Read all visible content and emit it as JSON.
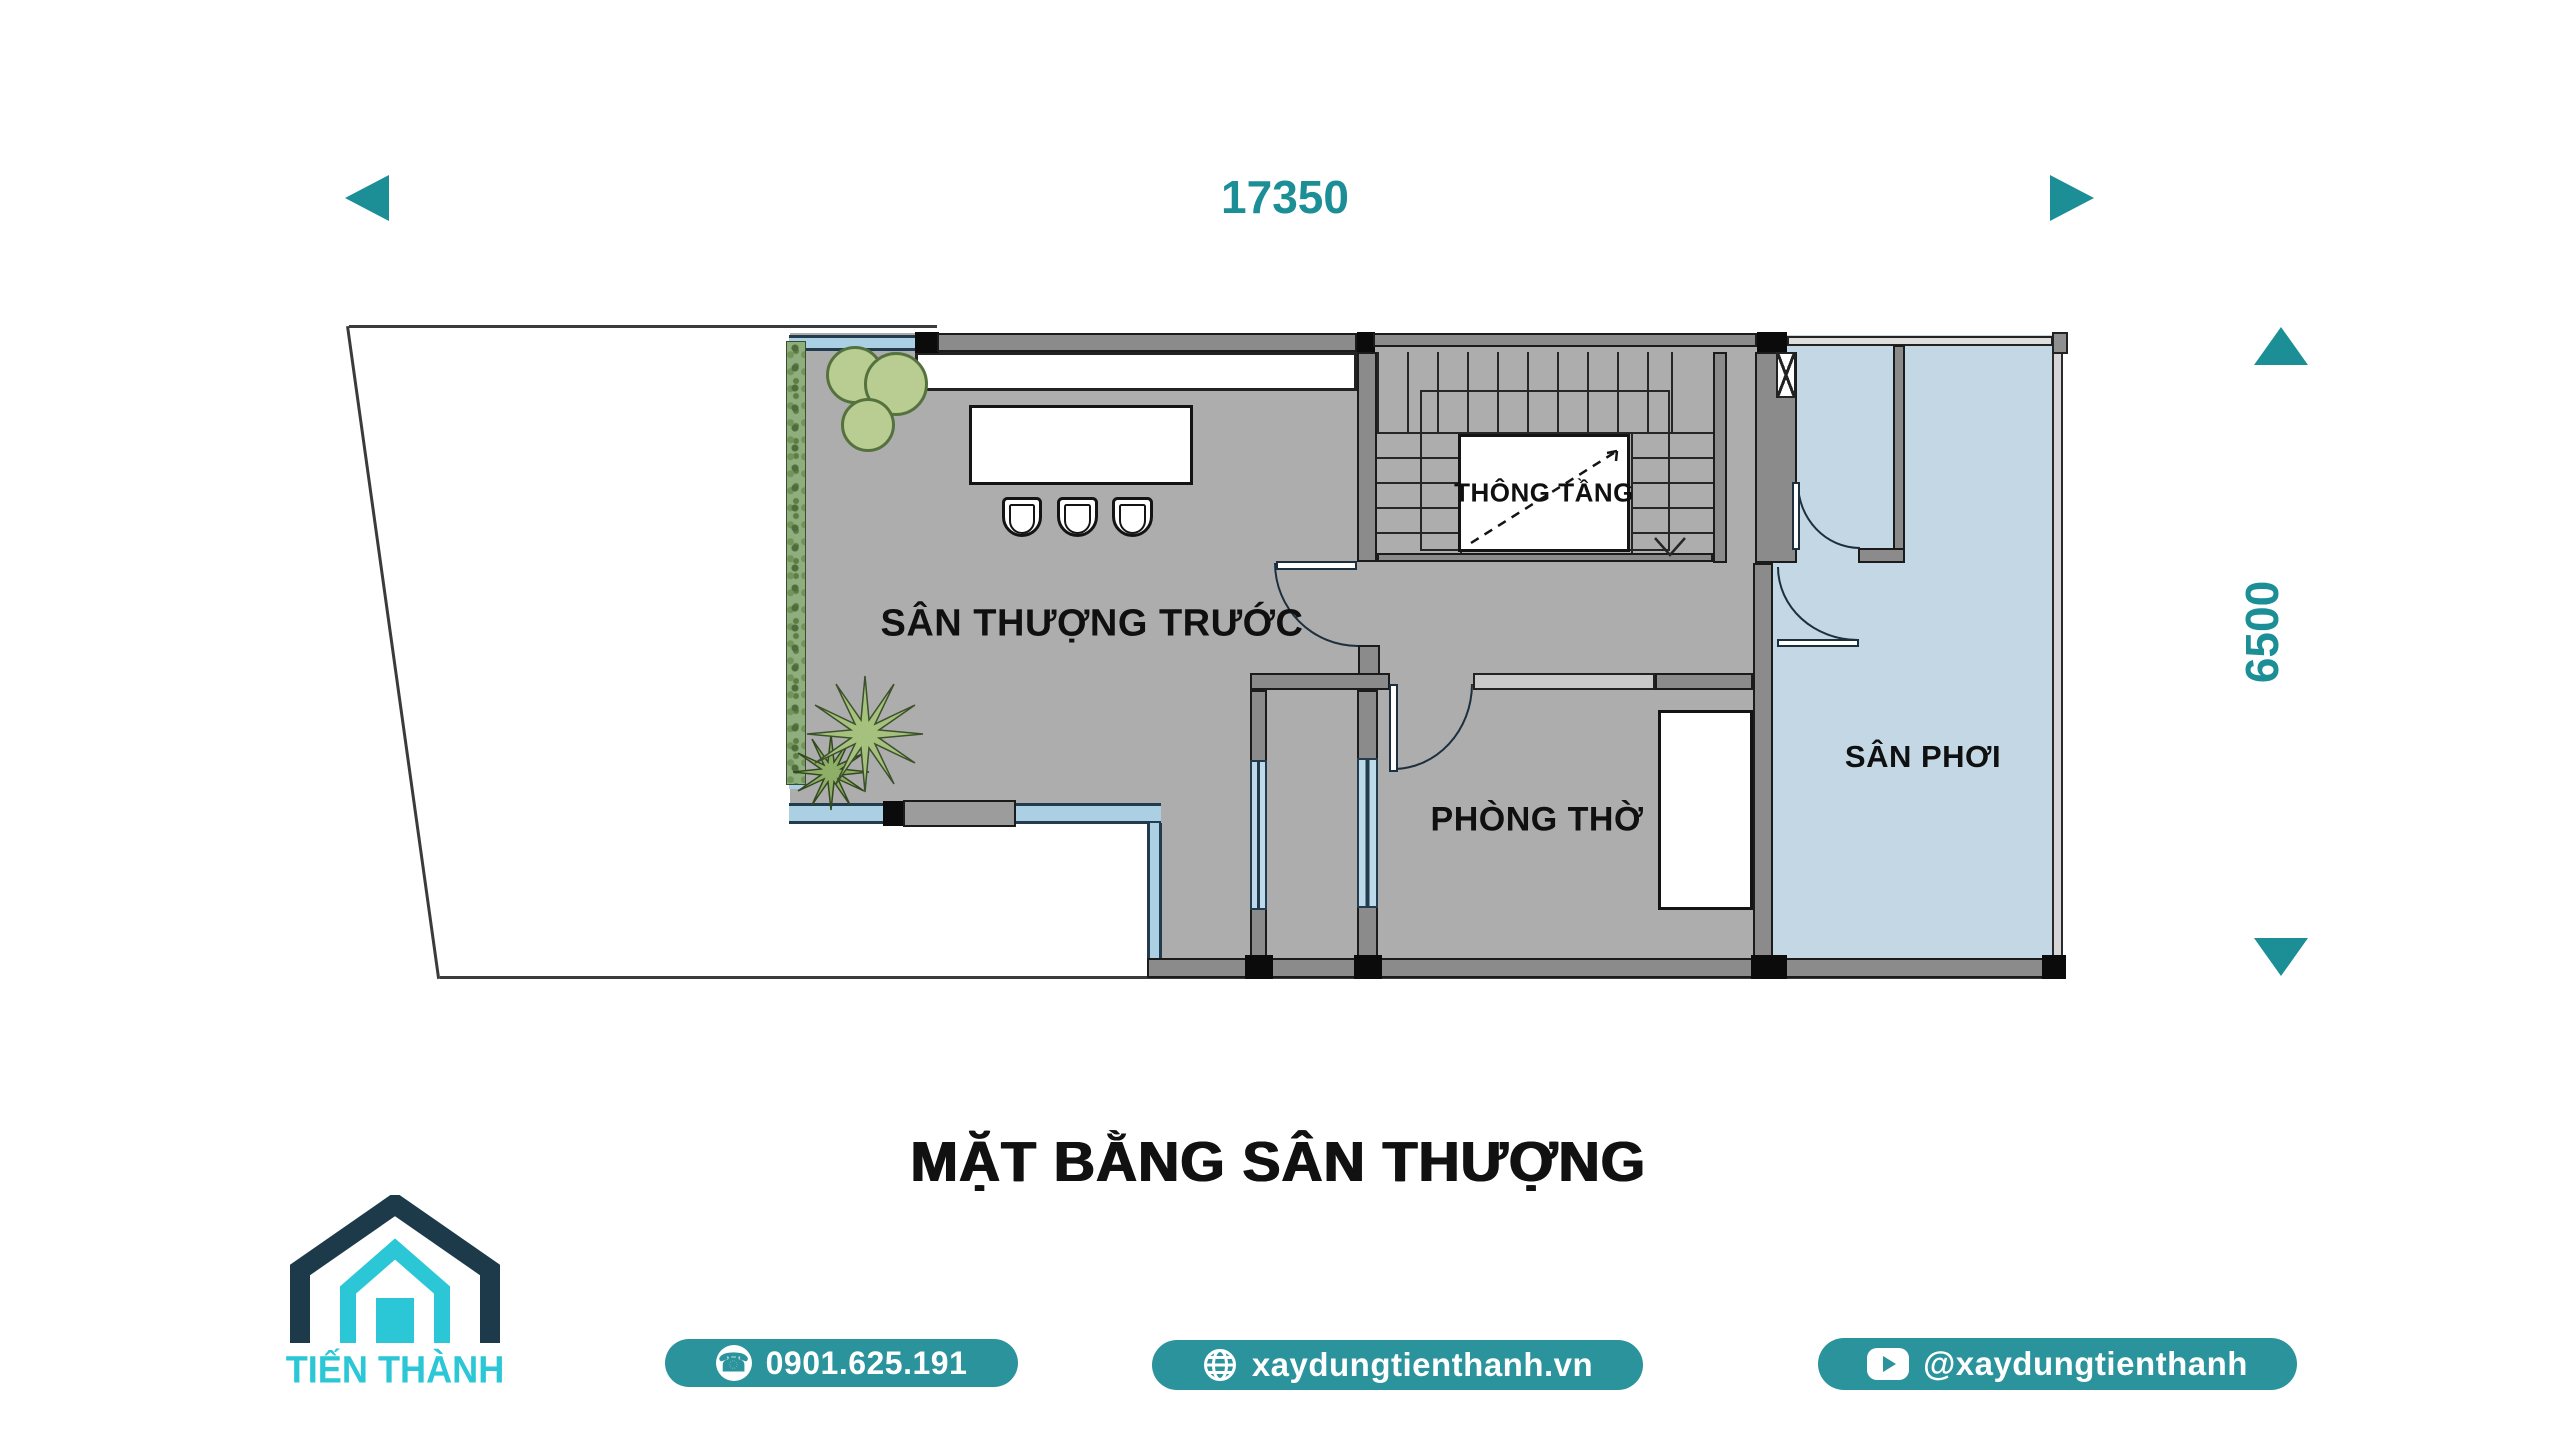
{
  "dimensions": {
    "width_label": "17350",
    "height_label": "6500"
  },
  "rooms": {
    "terrace": "SÂN THƯỢNG TRƯỚC",
    "void": "THÔNG TẦNG",
    "worship": "PHÒNG THỜ",
    "drying": "SÂN PHƠI"
  },
  "title": "MẶT BẰNG SÂN THƯỢNG",
  "brand": {
    "name": "TIẾN THÀNH",
    "phone": "0901.625.191",
    "website": "xaydungtienthanh.vn",
    "social_handle": "@xaydungtienthanh"
  },
  "icons": {
    "phone_glyph": "☎"
  },
  "colors": {
    "teal": "#1B8E96",
    "badge_teal": "#2B939C",
    "logo_navy": "#1C3A49",
    "logo_cyan": "#2BC7D6",
    "floor_gray": "#ADADAD",
    "wall_gray": "#8B8B8B",
    "yard_blue": "#C3D8E4",
    "railing_blue": "#ABD0E4",
    "window_blue": "#BCDAEA",
    "plant_green": "#B9CC92"
  }
}
